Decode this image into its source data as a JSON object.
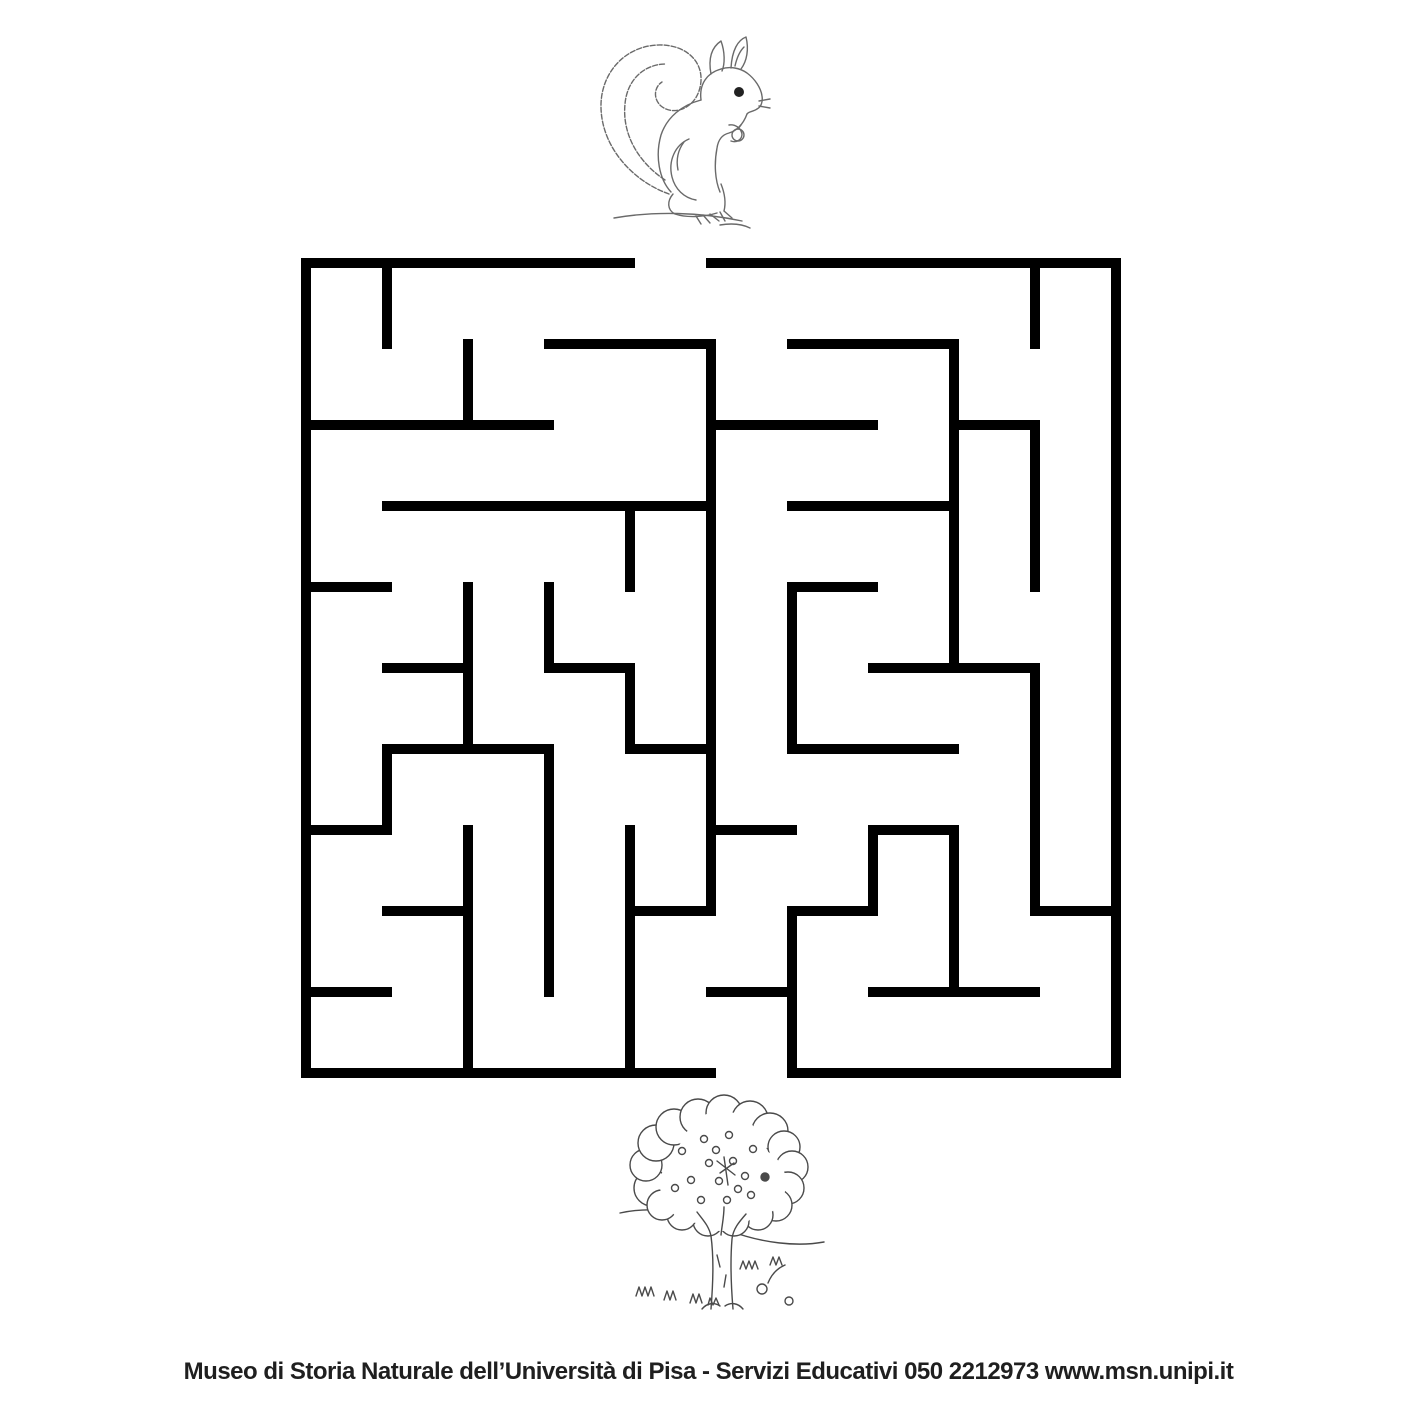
{
  "page": {
    "background": "#ffffff"
  },
  "footer": {
    "text": "Museo di Storia Naturale dell’Università di Pisa - Servizi Educativi 050 2212973  www.msn.unipi.it",
    "color": "#1f1f1f"
  },
  "maze": {
    "wall_color": "#000000",
    "wall_thickness": 10,
    "cell_size": 81,
    "rows": 10,
    "cols": 10,
    "origin": {
      "x": 306,
      "y": 263
    },
    "entrance": {
      "side": "top",
      "col": 4
    },
    "exit": {
      "side": "bottom",
      "col": 5
    },
    "h_walls": [
      {
        "row": 0,
        "cols": [
          0,
          1,
          2,
          3,
          5,
          6,
          7,
          8,
          9
        ]
      },
      {
        "row": 1,
        "cols": [
          3,
          4,
          6,
          7
        ]
      },
      {
        "row": 2,
        "cols": [
          0,
          1,
          2,
          5,
          6,
          8
        ]
      },
      {
        "row": 3,
        "cols": [
          1,
          2,
          3,
          4,
          6,
          7
        ]
      },
      {
        "row": 4,
        "cols": [
          0,
          6
        ]
      },
      {
        "row": 5,
        "cols": [
          1,
          3,
          7,
          8
        ]
      },
      {
        "row": 6,
        "cols": [
          1,
          2,
          4,
          6,
          7
        ]
      },
      {
        "row": 7,
        "cols": [
          0,
          5,
          7
        ]
      },
      {
        "row": 8,
        "cols": [
          1,
          4,
          6,
          9
        ]
      },
      {
        "row": 9,
        "cols": [
          0,
          5,
          7,
          8
        ]
      },
      {
        "row": 10,
        "cols": [
          0,
          1,
          2,
          3,
          4,
          6,
          7,
          8,
          9
        ]
      }
    ],
    "v_walls": [
      {
        "col": 0,
        "rows": [
          0,
          1,
          2,
          3,
          4,
          5,
          6,
          7,
          8,
          9
        ]
      },
      {
        "col": 1,
        "rows": [
          0,
          6
        ]
      },
      {
        "col": 2,
        "rows": [
          1,
          4,
          5,
          7,
          8,
          9
        ]
      },
      {
        "col": 3,
        "rows": [
          4,
          6,
          7,
          8
        ]
      },
      {
        "col": 4,
        "rows": [
          3,
          5,
          7,
          8,
          9
        ]
      },
      {
        "col": 5,
        "rows": [
          1,
          2,
          3,
          4,
          5,
          6,
          7
        ]
      },
      {
        "col": 6,
        "rows": [
          4,
          5,
          8,
          9
        ]
      },
      {
        "col": 7,
        "rows": [
          7
        ]
      },
      {
        "col": 8,
        "rows": [
          1,
          2,
          3,
          4,
          7,
          8
        ]
      },
      {
        "col": 9,
        "rows": [
          0,
          2,
          3,
          5,
          6,
          7
        ]
      },
      {
        "col": 10,
        "rows": [
          0,
          1,
          2,
          3,
          4,
          5,
          6,
          7,
          8,
          9
        ]
      }
    ]
  },
  "illustrations": {
    "start": "squirrel",
    "end": "tree",
    "squirrel_stroke": "#6a6a6a",
    "tree_stroke": "#4a4a4a"
  }
}
